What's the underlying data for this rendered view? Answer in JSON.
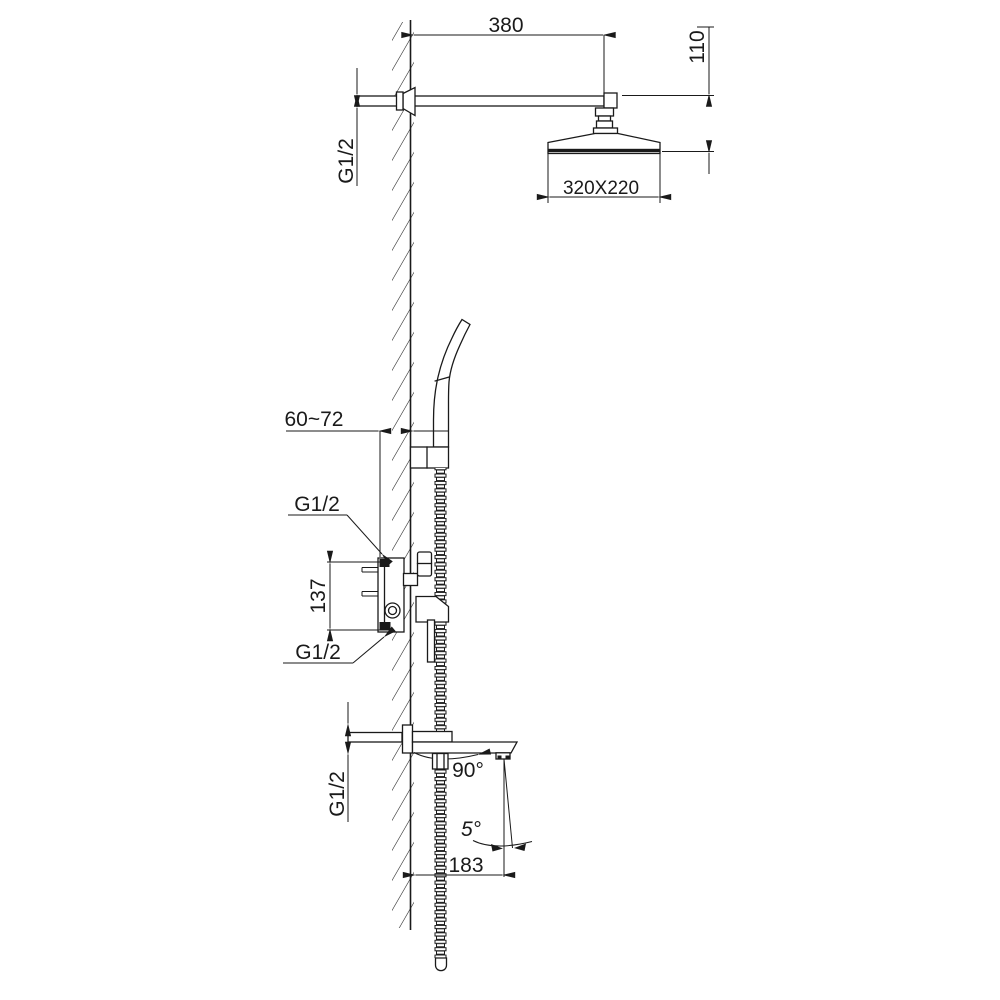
{
  "labels": {
    "arm_length": "380",
    "head_drop": "110",
    "arm_thread": "G1/2",
    "head_size": "320X220",
    "valve_depth": "60~72",
    "inlet_top_thread": "G1/2",
    "inlet_spacing": "137",
    "inlet_bottom_thread": "G1/2",
    "spout_swivel": "90°",
    "spray_angle": "5°",
    "spout_reach": "183",
    "spout_thread": "G1/2"
  },
  "colors": {
    "line": "#1a1a1a",
    "background": "#ffffff"
  }
}
